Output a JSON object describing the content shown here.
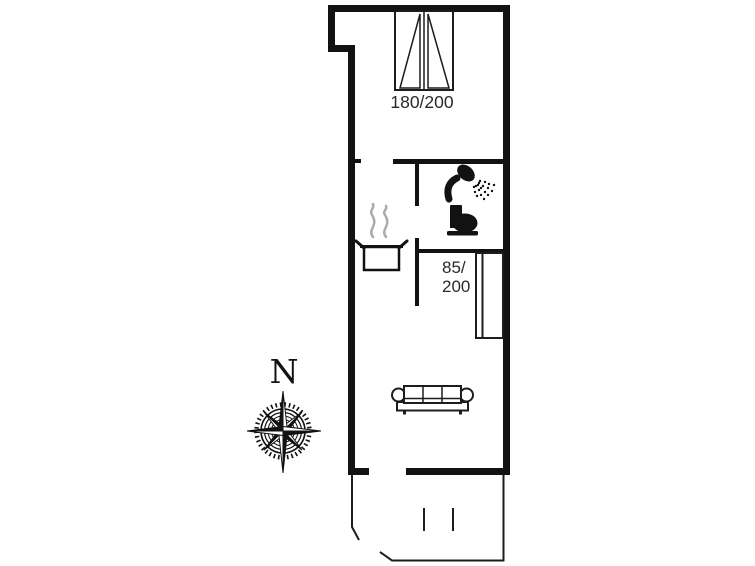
{
  "page": {
    "kind": "vacation-home floor plan drawing",
    "background": "#ffffff"
  },
  "labels": {
    "double_bed_size": "180/200",
    "single_bed_size_line1": "85/",
    "single_bed_size_line2": "200",
    "compass_north": "N"
  },
  "colors": {
    "wall": "#121212",
    "furniture_line": "#1c1c1c",
    "label_text": "#2a2a2a",
    "steam": "#ababab",
    "background": "#ffffff"
  },
  "icons": [
    "compass-rose-icon",
    "double-bed-icon",
    "single-bed-icon",
    "shower-icon",
    "toilet-icon",
    "cooking-pot-icon",
    "sofa-icon"
  ]
}
